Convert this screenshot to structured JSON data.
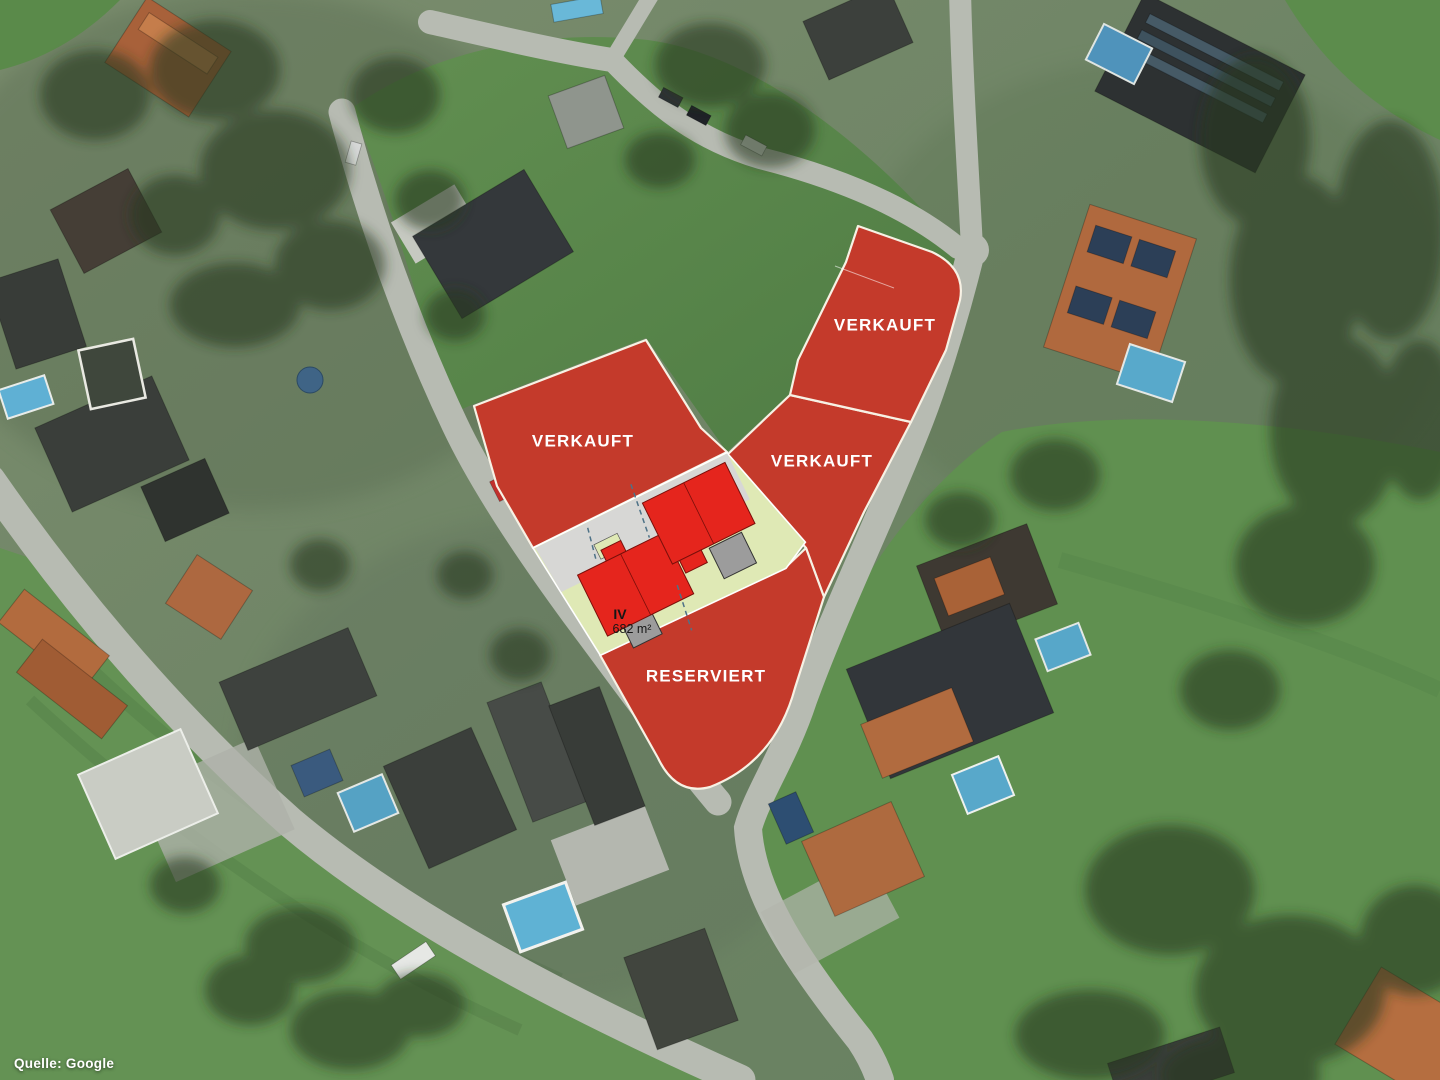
{
  "attribution": {
    "text": "Quelle: Google"
  },
  "colors": {
    "overlay_red": "#c43a2b",
    "building_red": "#e5251d",
    "garage_gray": "#9c9c9c",
    "plot_green": "#dfe9b5",
    "driveway_gray": "#d7d7d5",
    "boundary_white": "#f7f1e4"
  },
  "plots": [
    {
      "id": "plot-west",
      "status": "VERKAUFT"
    },
    {
      "id": "plot-middle",
      "status": "VERKAUFT"
    },
    {
      "id": "plot-northeast",
      "status": "VERKAUFT"
    },
    {
      "id": "plot-south",
      "status": "RESERVIERT"
    },
    {
      "id": "plot-iv",
      "number": "IV",
      "area": "682 m²"
    }
  ]
}
